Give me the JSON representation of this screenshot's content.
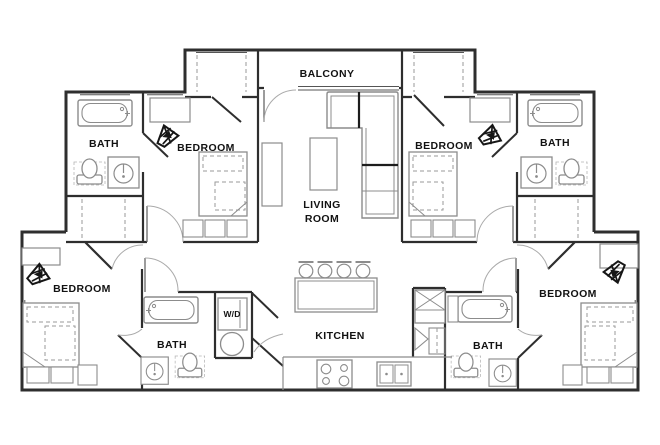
{
  "floor_plan": {
    "background": "#ffffff",
    "wall_color": "#2e2e2e",
    "furniture_color": "#8c8c8c",
    "label_color": "#121212",
    "rooms": [
      {
        "id": "balcony",
        "label": "BALCONY"
      },
      {
        "id": "bath-top-left",
        "label": "BATH"
      },
      {
        "id": "bedroom-top-left",
        "label": "BEDROOM"
      },
      {
        "id": "bedroom-top-right",
        "label": "BEDROOM"
      },
      {
        "id": "bath-top-right",
        "label": "BATH"
      },
      {
        "id": "living-room",
        "label_line1": "LIVING",
        "label_line2": "ROOM"
      },
      {
        "id": "bedroom-bottom-left",
        "label": "BEDROOM"
      },
      {
        "id": "bath-bottom-left",
        "label": "BATH"
      },
      {
        "id": "laundry-closet",
        "label": "W/D"
      },
      {
        "id": "kitchen",
        "label": "KITCHEN"
      },
      {
        "id": "bath-bottom-right",
        "label": "BATH"
      },
      {
        "id": "bedroom-bottom-right",
        "label": "BEDROOM"
      }
    ]
  }
}
